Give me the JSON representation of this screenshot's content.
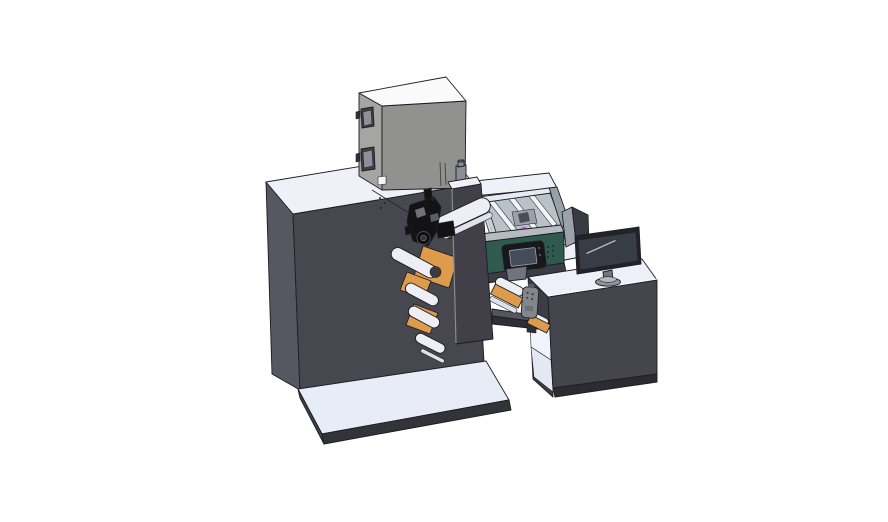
{
  "scene": {
    "background": "#ffffff",
    "subject": "3D CAD render of a label printing machine with unwind rollers, glass enclosure, HMI control unit and operator desk with monitor",
    "components": [
      "main-cabinet",
      "top-unit-box",
      "ink-bottle",
      "glass-enclosure",
      "teal-control-unit",
      "hmi-display",
      "unwind-orange-plates",
      "web-rollers",
      "print-head-mechanism",
      "side-cover-pillar",
      "transfer-beam",
      "pendant-remote",
      "rewind-unit",
      "operator-desk",
      "desk-kneehole",
      "desk-monitor",
      "rear-monitor-panel",
      "floor-platform"
    ]
  },
  "colors": {
    "outline": "#1d1d22",
    "cabinetTop": "#eef1f8",
    "cabinetSide": "#575761",
    "cabinetFront": "#47474f",
    "seam": "#26262c",
    "platformTop": "#e8ecf6",
    "platformFront": "#33333a",
    "platformSide": "#404049",
    "boxTop": "#fafafa",
    "boxSide": "#a5a5a3",
    "boxFront": "#919190",
    "boxSlot": "#3f3f45",
    "boxWindowInner": "#8f8f99",
    "whiteSquare": "#f4f5f8",
    "hinge": "#2e2e34",
    "bottleBody": "#8d8d95",
    "bottleDark": "#515158",
    "glassFloor": "#b4bdc5",
    "glassLeftWall": "#ccd4db",
    "glassRightWall": "#98a1a9",
    "glassBackRim": "#e7ebf1",
    "slatWhite": "#f1f4f8",
    "machineryGrey": "#9aa1a9",
    "machineryDark": "#4a4f57",
    "magenta": "#c95fd0",
    "tealRim": "#b6bbc3",
    "tealSide": "#23453c",
    "tealFace": "#2f5a4e",
    "ventDark": "#152f28",
    "hmiBody": "#17171c",
    "hmiScreen": "#454c59",
    "hmiDot": "#5a5a62",
    "orange": "#dd9b4b",
    "roller": "#edeff5",
    "rollerSlat": "#dde2eb",
    "rollerEndDark": "#3a3a40",
    "pillarFace": "#414049",
    "pillarEdge": "#8b8b96",
    "mechBlack": "#131316",
    "mechGrey": "#71717a",
    "deckEdge": "#3c3c44",
    "deskTop": "#edf0f8",
    "deskSide": "#3d3d45",
    "deskFront": "#45454e",
    "deskPlinth": "#2b2b31",
    "kneeWall": "#f0f3f9",
    "kneeFloor": "#e3e8f3",
    "deskEdgeHighlight": "#fbfcfe",
    "beamTop": "#55555e",
    "beamFront": "#2e2e35",
    "pendantBody": "#84868e",
    "pendantDot": "#3f3f46",
    "pendantBtn": "#6d6f77",
    "pendantTop": "#5a5c63",
    "dividerLight": "#9aa2ac",
    "dividerDark": "#3a3a41",
    "monitorBezel": "#222228",
    "monitorScreen": "#383c44",
    "screenHighlight": "#b9bec8",
    "standNeck": "#70747c",
    "standBase": "#8e929b",
    "standBaseTop": "#b4b8c1"
  }
}
